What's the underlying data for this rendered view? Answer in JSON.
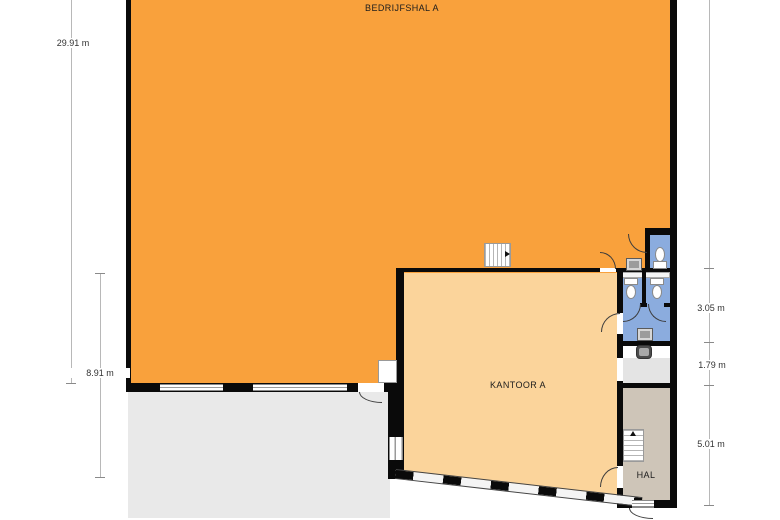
{
  "rooms": {
    "hall": {
      "label": "BEDRIJFSHAL A"
    },
    "office": {
      "label": "KANTOOR A"
    },
    "hallway": {
      "label": "HAL"
    }
  },
  "dimensions": {
    "left_outer": "29.91 m",
    "left_inner": "8.91 m",
    "right_top": "3.05 m",
    "right_middle": "1.79 m",
    "right_bottom": "5.01 m"
  },
  "colors": {
    "hall": "#F9A13C",
    "office": "#FBD49B",
    "sanitary": "#8BACDE",
    "hallway": "#CEC5B8",
    "outside": "#E9E9E9",
    "wall": "#0A0A0A"
  },
  "icons": {
    "toilet-icon": "css oval bowl + tank rectangle",
    "sink-icon": "css square with inner basin",
    "stairs-icon": "css striped rectangle with direction arrow",
    "door-arc-icon": "css quarter-circle swing"
  }
}
